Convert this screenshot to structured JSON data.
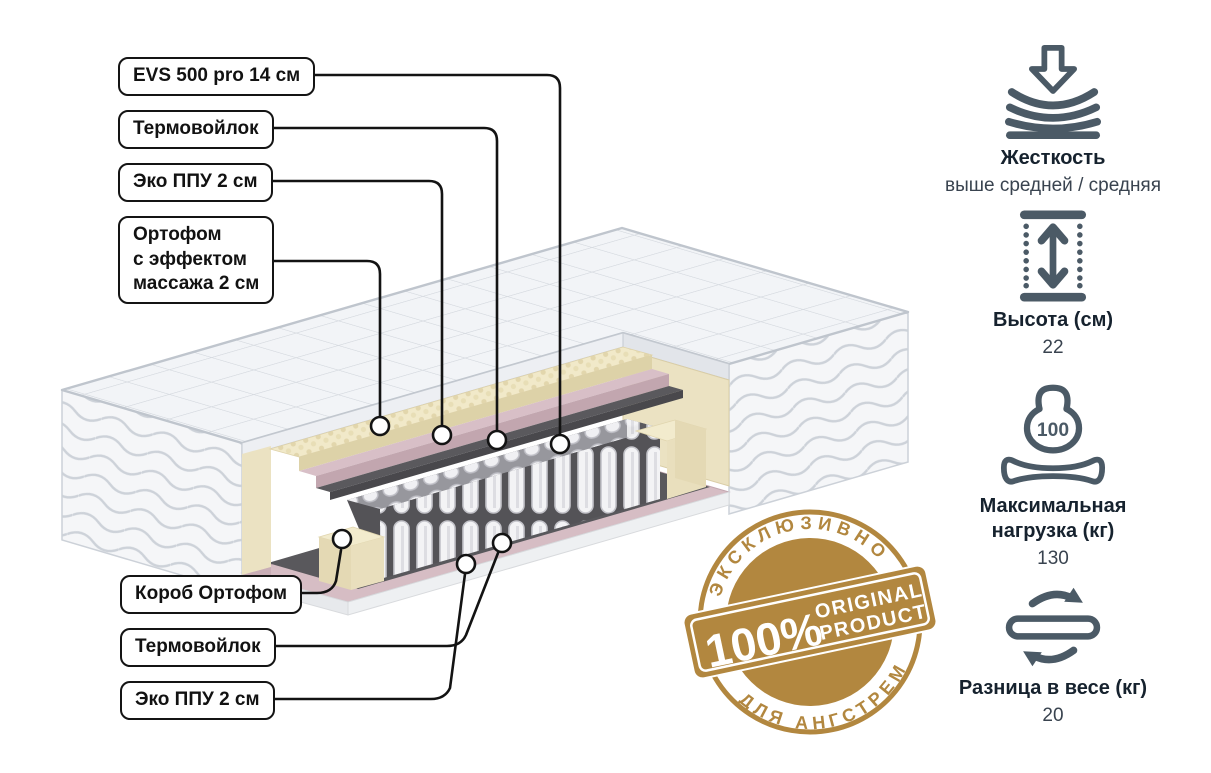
{
  "page": {
    "background": "#ffffff"
  },
  "colors": {
    "line_black": "#131313",
    "icon_slate": "#4b5a66",
    "badge_gold": "#b2873f",
    "quilt_fabric": "#f2f4f7",
    "foam_cream": "#f1e9c9",
    "foam_pink": "#d8bfc7",
    "felt_gray": "#5a595d",
    "spring_white": "#f3f3f5"
  },
  "layer_labels": [
    {
      "text": "EVS 500 pro 14 см"
    },
    {
      "text": "Термовойлок"
    },
    {
      "text": "Эко ППУ 2 см"
    },
    {
      "text": "Ортофом\nс эффектом\nмассажа 2 см"
    },
    {
      "text": "Короб Ортофом"
    },
    {
      "text": "Термовойлок"
    },
    {
      "text": "Эко ППУ 2 см"
    }
  ],
  "specs": [
    {
      "icon": "firmness-icon",
      "title": "Жесткость",
      "value": "выше средней / средняя"
    },
    {
      "icon": "height-icon",
      "title": "Высота (см)",
      "value": "22"
    },
    {
      "icon": "max-load-icon",
      "title": "Максимальная нагрузка (кг)",
      "value": "130",
      "icon_text": "100"
    },
    {
      "icon": "flip-weight-icon",
      "title": "Разница в весе (кг)",
      "value": "20"
    }
  ],
  "badge": {
    "top_arc": "ЭКСКЛЮЗИВНО",
    "bottom_arc": "ДЛЯ АНГСТРЕМ",
    "percent": "100%",
    "product_line1": "ORIGINAL",
    "product_line2": "PRODUCT"
  }
}
